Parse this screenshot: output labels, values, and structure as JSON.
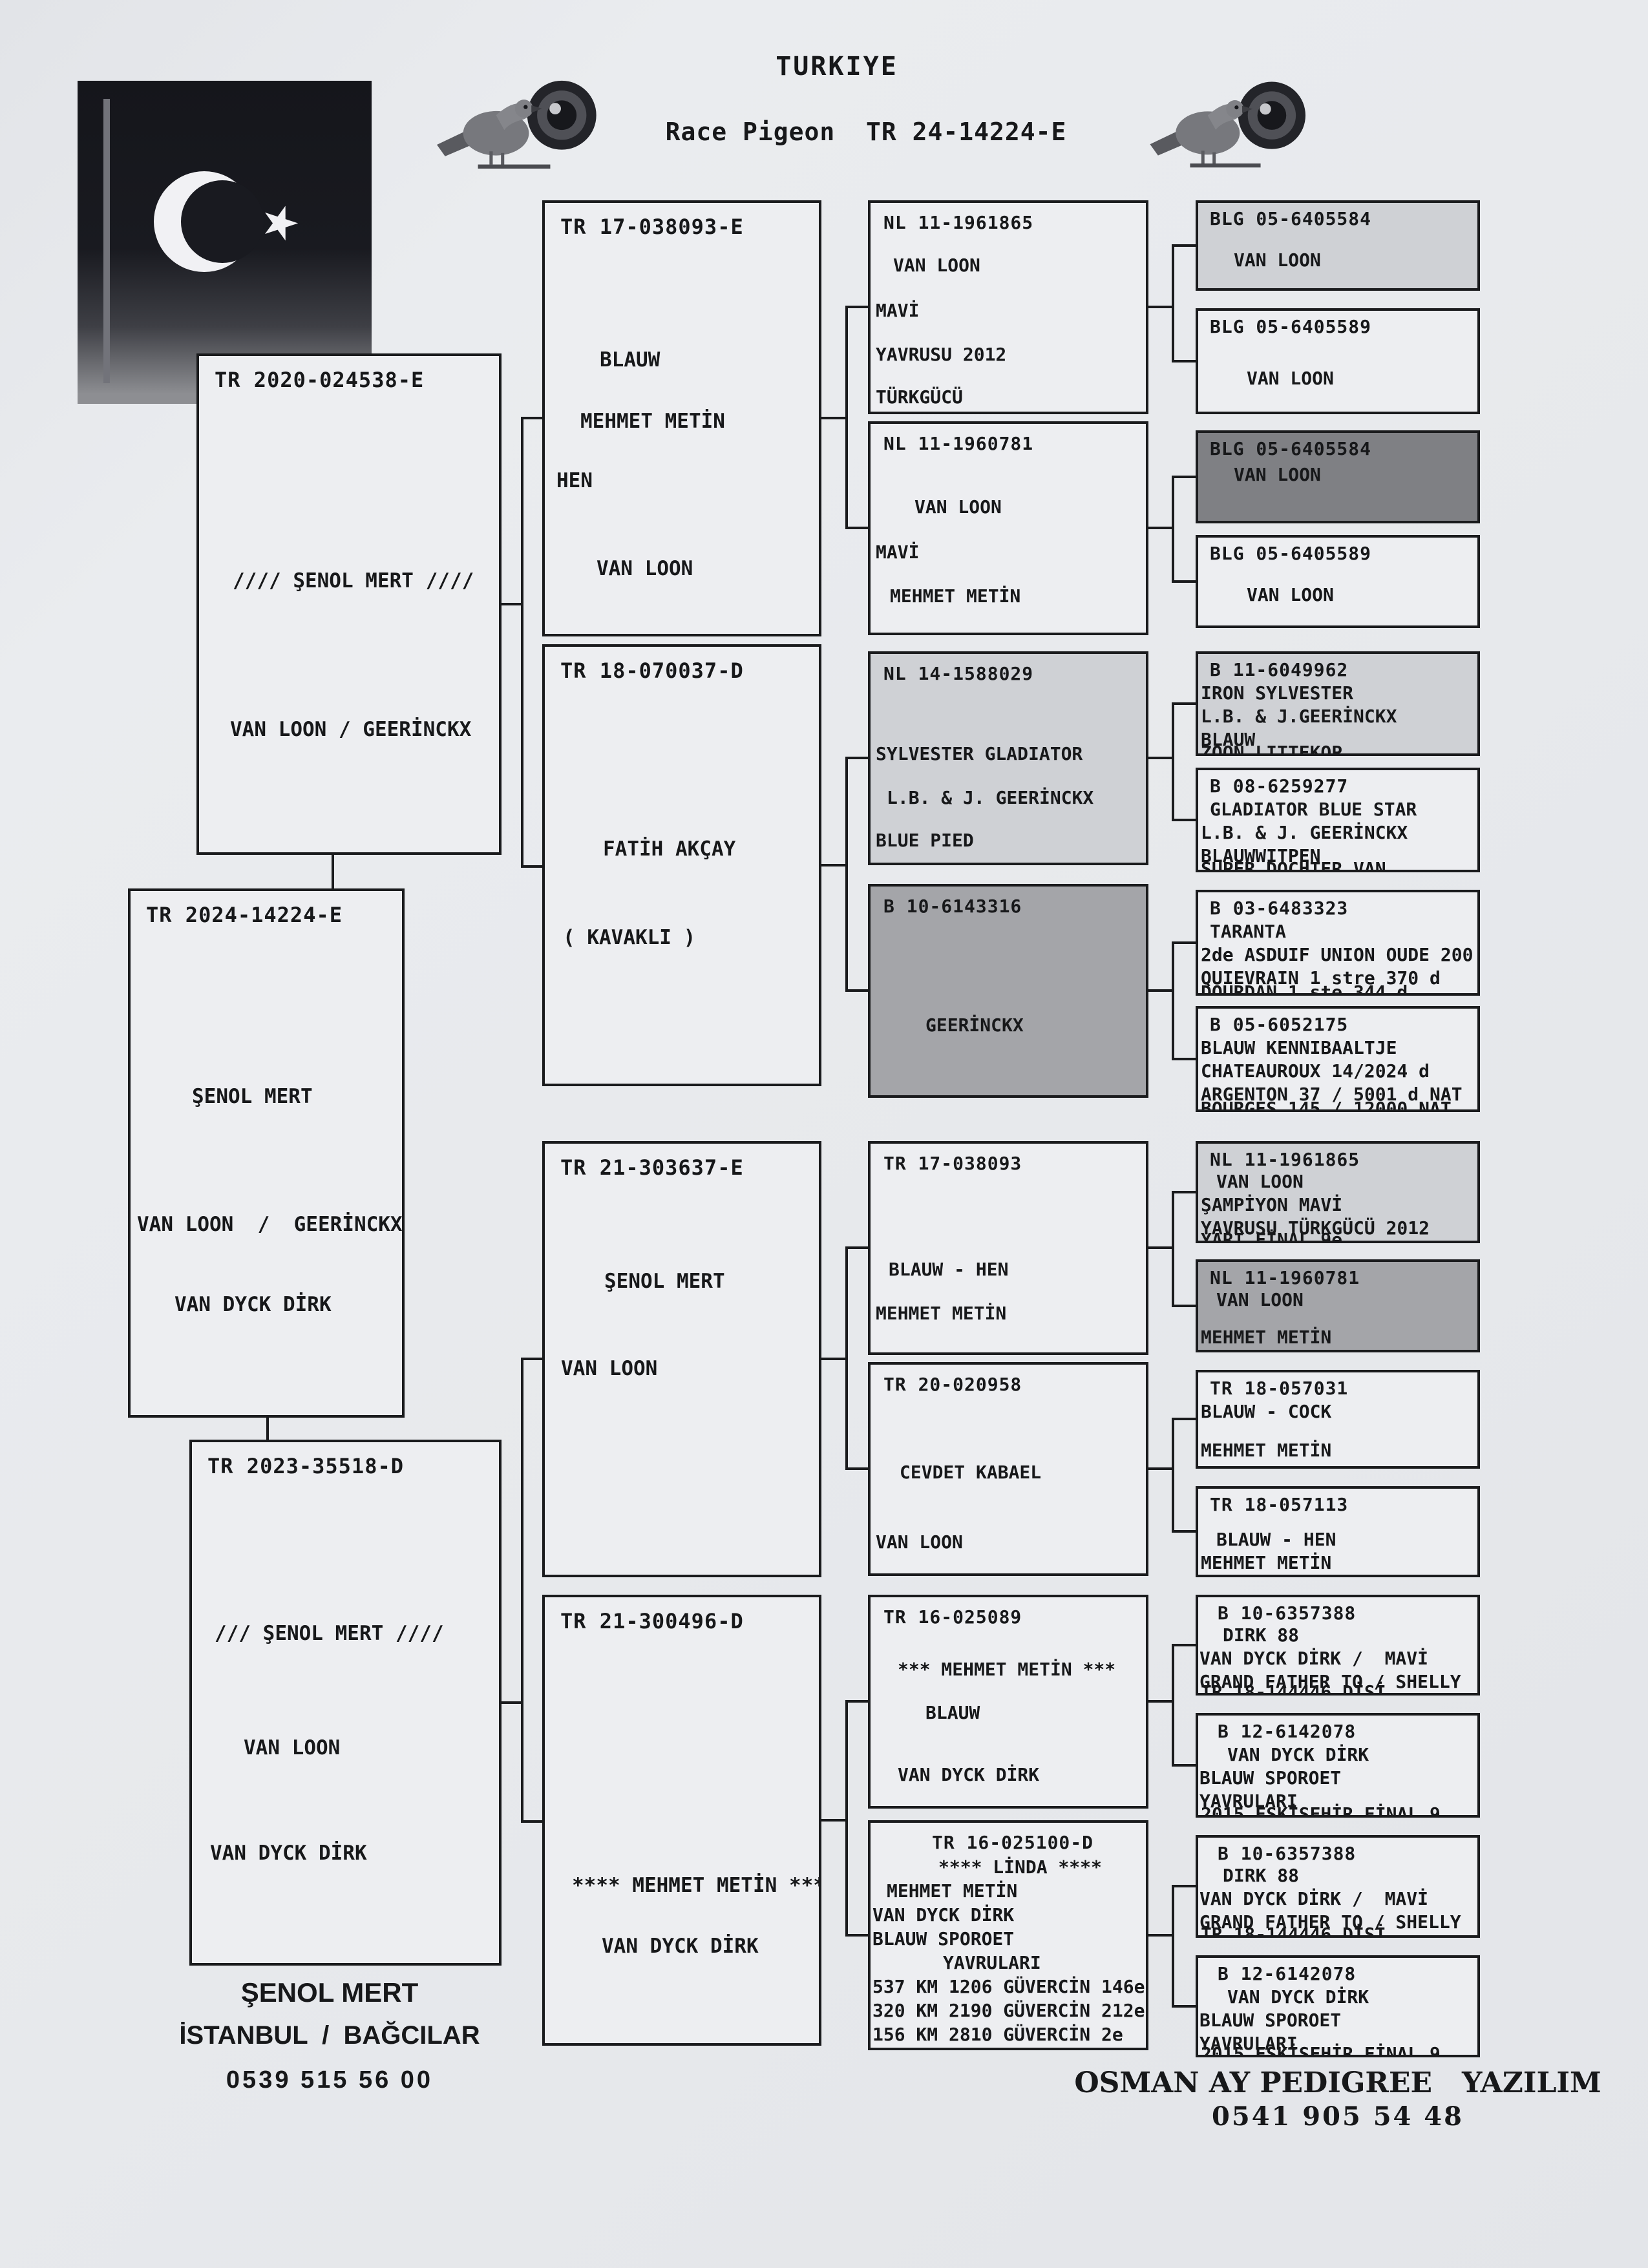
{
  "header": {
    "title": "TURKIYE",
    "subtitle": "Race Pigeon  TR 24-14224-E"
  },
  "footer": {
    "owner": "ŞENOL MERT",
    "location": "İSTANBUL  /  BAĞCILAR",
    "phone": "0539 515 56 00",
    "software": "OSMAN AY PEDIGREE   YAZILIM",
    "software_phone": "0541 905 54 48"
  },
  "icons": {
    "flag": "turkish-flag",
    "pigeon": "pigeon"
  },
  "colors": {
    "paper": "#e7e9ec",
    "ink": "#1a1b1d",
    "shade_light": "#cfd1d5",
    "shade_medium": "#a4a5a9",
    "shade_dark": "#7f8084"
  },
  "boxes": {
    "father": {
      "ring": "TR 2020-024538-E",
      "lines": [
        "//// ŞENOL MERT ////",
        "VAN LOON / GEERİNCKX"
      ]
    },
    "subject": {
      "ring": "TR 2024-14224-E",
      "lines": [
        "ŞENOL MERT",
        "VAN LOON  /  GEERİNCKX",
        "VAN DYCK DİRK"
      ]
    },
    "mother": {
      "ring": "TR 2023-35518-D",
      "lines": [
        "/// ŞENOL MERT ////",
        "VAN LOON",
        "VAN DYCK DİRK"
      ]
    },
    "g2a": {
      "ring": "TR 17-038093-E",
      "lines": [
        "BLAUW",
        "MEHMET METİN",
        "HEN",
        "VAN LOON"
      ]
    },
    "g2b": {
      "ring": "TR 18-070037-D",
      "lines": [
        "FATİH AKÇAY",
        "( KAVAKLI )"
      ]
    },
    "g2c": {
      "ring": "TR 21-303637-E",
      "lines": [
        "ŞENOL MERT",
        "VAN LOON"
      ]
    },
    "g2d": {
      "ring": "TR 21-300496-D",
      "lines": [
        "**** MEHMET METİN ****",
        "VAN DYCK DİRK"
      ]
    },
    "g3a": {
      "ring": "NL 11-1961865",
      "lines": [
        "VAN LOON",
        "MAVİ",
        "YAVRUSU 2012",
        "TÜRKGÜCÜ"
      ]
    },
    "g3b": {
      "ring": "NL 11-1960781",
      "lines": [
        "VAN LOON",
        "MAVİ",
        "MEHMET METİN"
      ]
    },
    "g3c": {
      "ring": "NL 14-1588029",
      "lines": [
        "SYLVESTER GLADIATOR",
        "L.B. & J. GEERİNCKX",
        "BLUE PIED"
      ]
    },
    "g3d": {
      "ring": "B 10-6143316",
      "lines": [
        "GEERİNCKX"
      ]
    },
    "g3e": {
      "ring": "TR 17-038093",
      "lines": [
        "BLAUW - HEN",
        "MEHMET METİN"
      ]
    },
    "g3f": {
      "ring": "TR 20-020958",
      "lines": [
        "CEVDET KABAEL",
        "VAN LOON"
      ]
    },
    "g3g": {
      "ring": "TR 16-025089",
      "lines": [
        "*** MEHMET METİN ***",
        "BLAUW",
        "VAN DYCK DİRK"
      ]
    },
    "g3h": {
      "ring": "TR 16-025100-D",
      "lines": [
        "**** LİNDA ****",
        "MEHMET METİN",
        "VAN DYCK DİRK",
        "BLAUW SPOROET",
        "YAVRULARI",
        "537 KM 1206 GÜVERCİN 146e",
        "320 KM 2190 GÜVERCİN 212e",
        "156 KM 2810 GÜVERCİN 2e"
      ]
    },
    "g4a": {
      "ring": "BLG 05-6405584",
      "lines": [
        "VAN LOON"
      ]
    },
    "g4b": {
      "ring": "BLG 05-6405589",
      "lines": [
        "VAN LOON"
      ]
    },
    "g4c": {
      "ring": "BLG 05-6405584",
      "lines": [
        "VAN LOON"
      ]
    },
    "g4d": {
      "ring": "BLG 05-6405589",
      "lines": [
        "VAN LOON"
      ]
    },
    "g4e": {
      "ring": "B 11-6049962",
      "lines": [
        "IRON SYLVESTER",
        "L.B. & J.GEERİNCKX",
        "BLAUW"
      ],
      "cut": "ZOON LITTEKOP"
    },
    "g4f": {
      "ring": "B 08-6259277",
      "lines": [
        "GLADIATOR BLUE STAR",
        "L.B. & J. GEERİNCKX",
        "BLAUWWITPEN"
      ],
      "cut": "SUPER DOCHTER VAN"
    },
    "g4g": {
      "ring": "B 03-6483323",
      "lines": [
        "TARANTA",
        "2de ASDUIF UNION OUDE 200",
        "QUIEVRAIN 1 stre 370 d"
      ],
      "cut": "DOURDAN 1 ste 344 d"
    },
    "g4h": {
      "ring": "B 05-6052175",
      "lines": [
        "BLAUW KENNIBAALTJE",
        "CHATEAUROUX 14/2024 d",
        "ARGENTON 37 / 5001 d NAT"
      ],
      "cut": "BOURGES 145 / 12000 NAT"
    },
    "g4i": {
      "ring": "NL 11-1961865",
      "lines": [
        "VAN LOON",
        "ŞAMPİYON MAVİ",
        "YAVRUSU TÜRKGÜCÜ 2012"
      ],
      "cut": "YARI FİNAL 9e"
    },
    "g4j": {
      "ring": "NL 11-1960781",
      "lines": [
        "VAN LOON",
        "MEHMET METİN"
      ]
    },
    "g4k": {
      "ring": "TR 18-057031",
      "lines": [
        "BLAUW - COCK",
        "MEHMET METİN"
      ]
    },
    "g4l": {
      "ring": "TR 18-057113",
      "lines": [
        "BLAUW - HEN",
        "MEHMET METİN"
      ]
    },
    "g4m": {
      "ring": "B 10-6357388",
      "lines": [
        "DIRK 88",
        "VAN DYCK DİRK /  MAVİ",
        "GRAND FATHER TO / SHELLY"
      ],
      "cut": "TR 18-144446 DİŞİ"
    },
    "g4n": {
      "ring": "B 12-6142078",
      "lines": [
        "VAN DYCK DİRK",
        "BLAUW SPOROET",
        "YAVRULARI"
      ],
      "cut": "2015 ESKİŞEHİR FİNAL 9"
    },
    "g4o": {
      "ring": "B 10-6357388",
      "lines": [
        "DIRK 88",
        "VAN DYCK DİRK /  MAVİ",
        "GRAND FATHER TO / SHELLY"
      ],
      "cut": "TR 18-144446 DİŞİ"
    },
    "g4p": {
      "ring": "B 12-6142078",
      "lines": [
        "VAN DYCK DİRK",
        "BLAUW SPOROET",
        "YAVRULARI"
      ],
      "cut": "2015 ESKİŞEHİR FİNAL 9"
    }
  }
}
